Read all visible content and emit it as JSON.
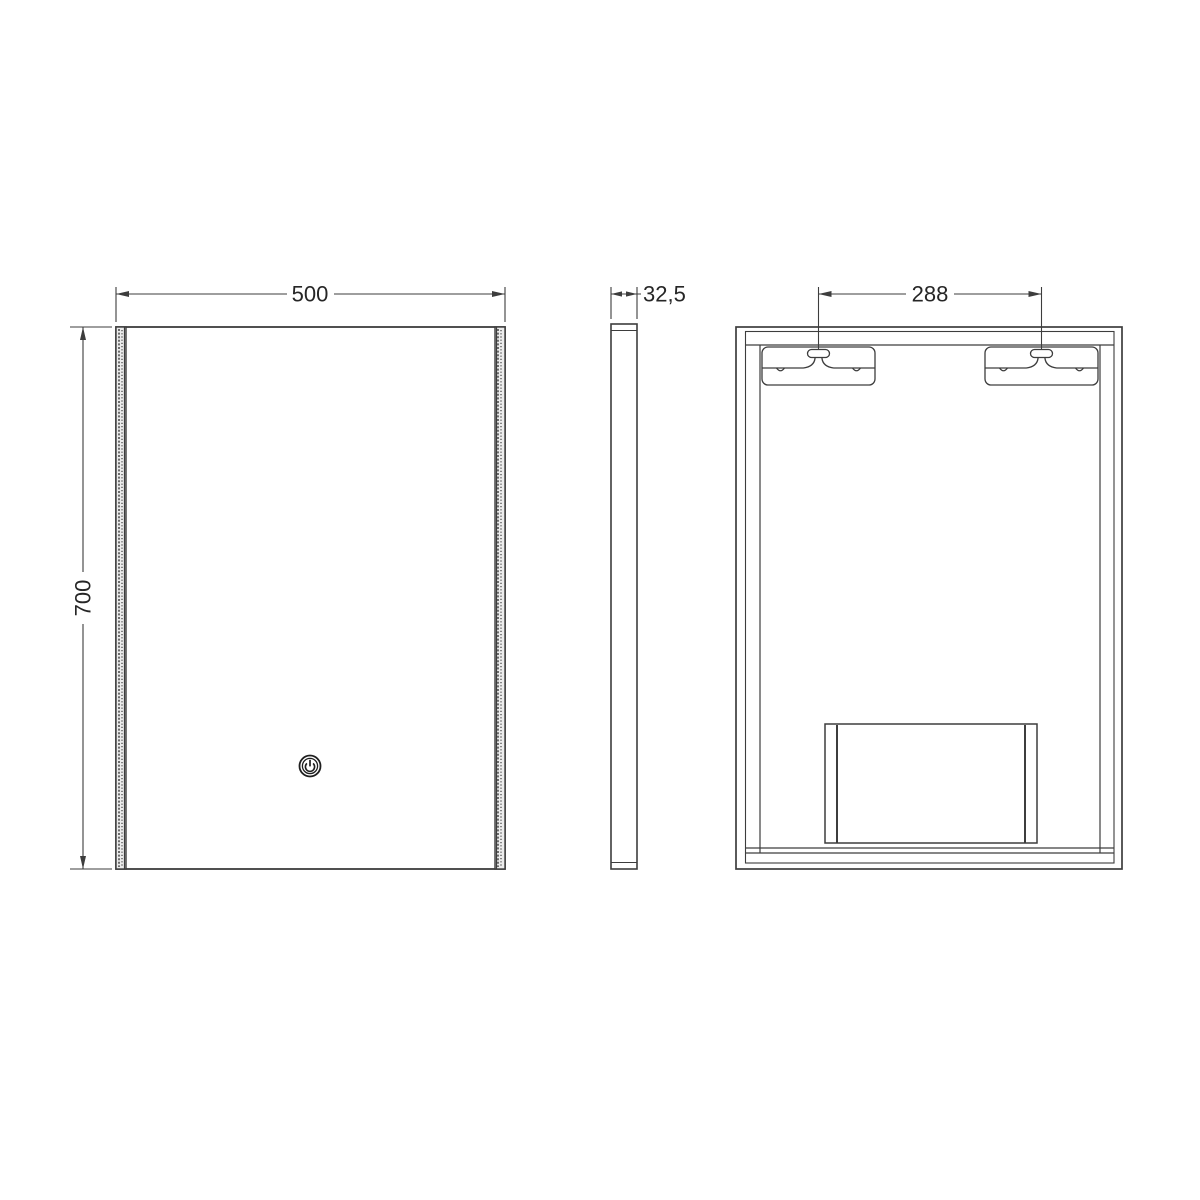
{
  "drawing": {
    "type": "technical-dimension-drawing",
    "subject": "illuminated-mirror",
    "views": {
      "front": {
        "width_dim": "500",
        "height_dim": "700"
      },
      "side": {
        "depth_dim": "32,5"
      },
      "back": {
        "bracket_spacing_dim": "288"
      }
    },
    "icons": {
      "power": "power-toggle-circle"
    },
    "colors": {
      "line": "#3d3d3d",
      "text": "#262626",
      "background": "#ffffff",
      "strip_fill": "#ececec"
    }
  }
}
